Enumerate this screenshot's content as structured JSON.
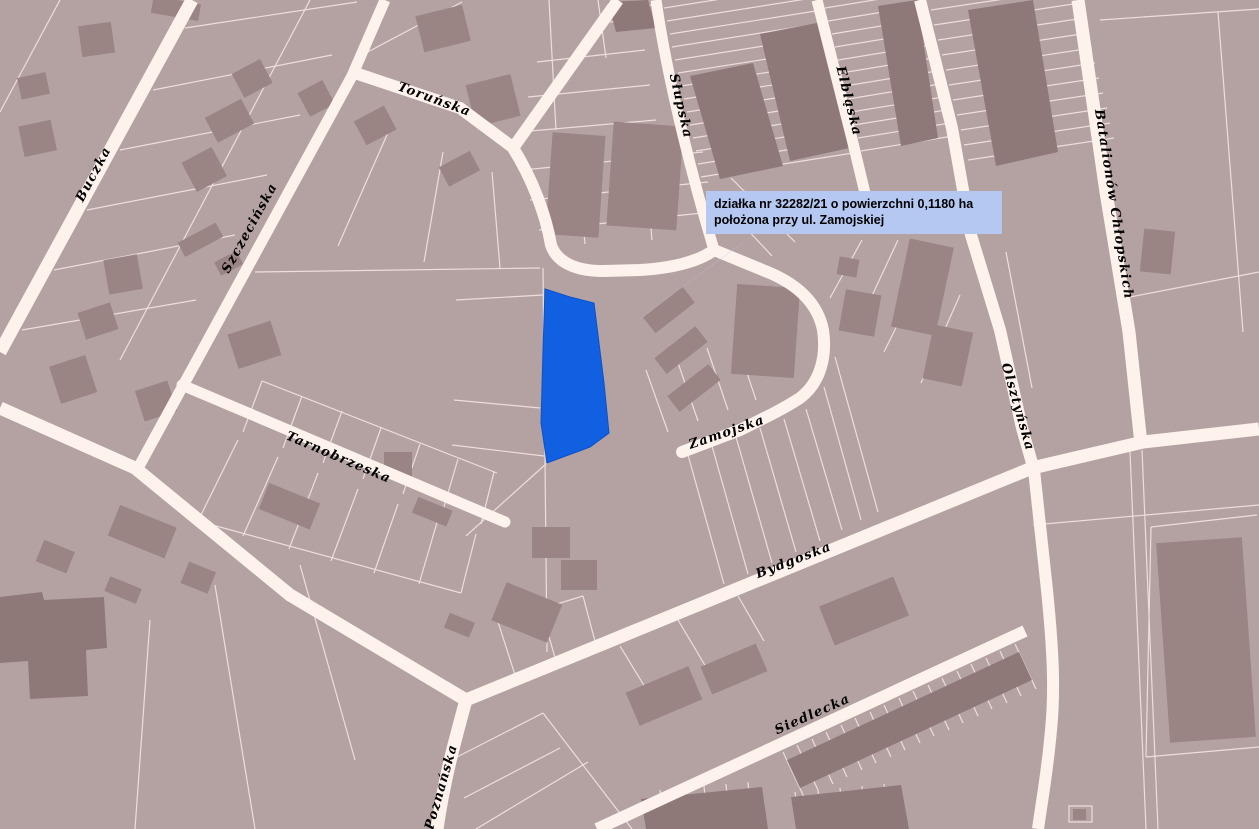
{
  "map": {
    "annotation": {
      "line1": "działka nr 32282/21 o powierzchni 0,1180 ha",
      "line2": "położona przy ul. Zamojskiej"
    },
    "parcel": {
      "number": "32282/21",
      "area_ha": "0,1180",
      "street": "ul. Zamojska"
    },
    "streets": [
      {
        "name": "Buczka"
      },
      {
        "name": "Szczecińska"
      },
      {
        "name": "Toruńska"
      },
      {
        "name": "Słupska"
      },
      {
        "name": "Elbląska"
      },
      {
        "name": "Batalionów Chłopskich"
      },
      {
        "name": "Olsztyńska"
      },
      {
        "name": "Zamojska"
      },
      {
        "name": "Tarnobrzeska"
      },
      {
        "name": "Bydgoska"
      },
      {
        "name": "Siedlecka"
      },
      {
        "name": "Poznańska"
      }
    ],
    "colors": {
      "background": "#b4a2a2",
      "road": "#fdf2ec",
      "parcel_line": "#eddddc",
      "building": "#9a8484",
      "building_dark": "#8f7878",
      "highlight_parcel": "#1160e2",
      "annotation_bg": "#b5c8f2",
      "annotation_text": "#000000",
      "leader": "#bcc9f0",
      "street_label_text": "#000000"
    }
  }
}
